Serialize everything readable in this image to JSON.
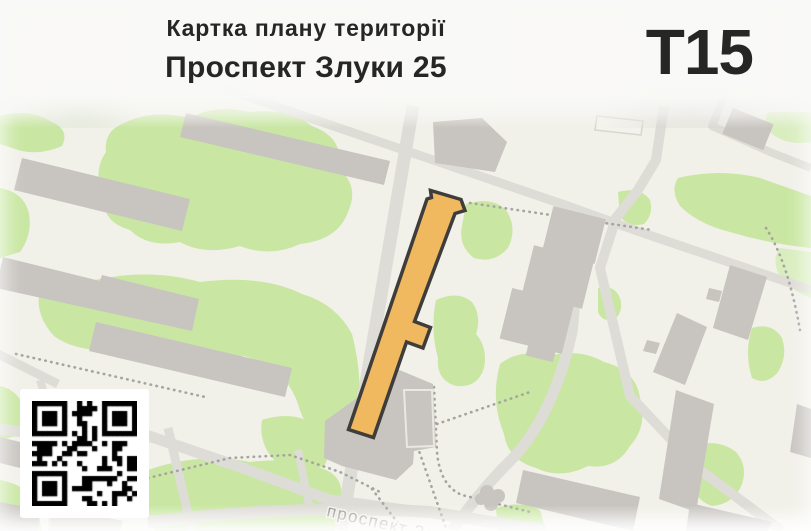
{
  "header": {
    "subtitle": "Картка плану території",
    "title": "Проспект Злуки 25",
    "code": "Т15"
  },
  "map": {
    "street_label": "проспект Злуки",
    "qr_icon": "qr-code",
    "colors": {
      "map_bg": "#f1f0e9",
      "green": "#c9e7a2",
      "green_soft": "#d9eebf",
      "building": "#c8c4c0",
      "building_light": "#d7d4cf",
      "road": "#dedcd6",
      "path_dots": "#a6a49f",
      "highlight_fill": "#f0b95f",
      "highlight_outline": "#3e3d3b",
      "street_text": "#8e8c88",
      "header_text": "#262624"
    }
  }
}
